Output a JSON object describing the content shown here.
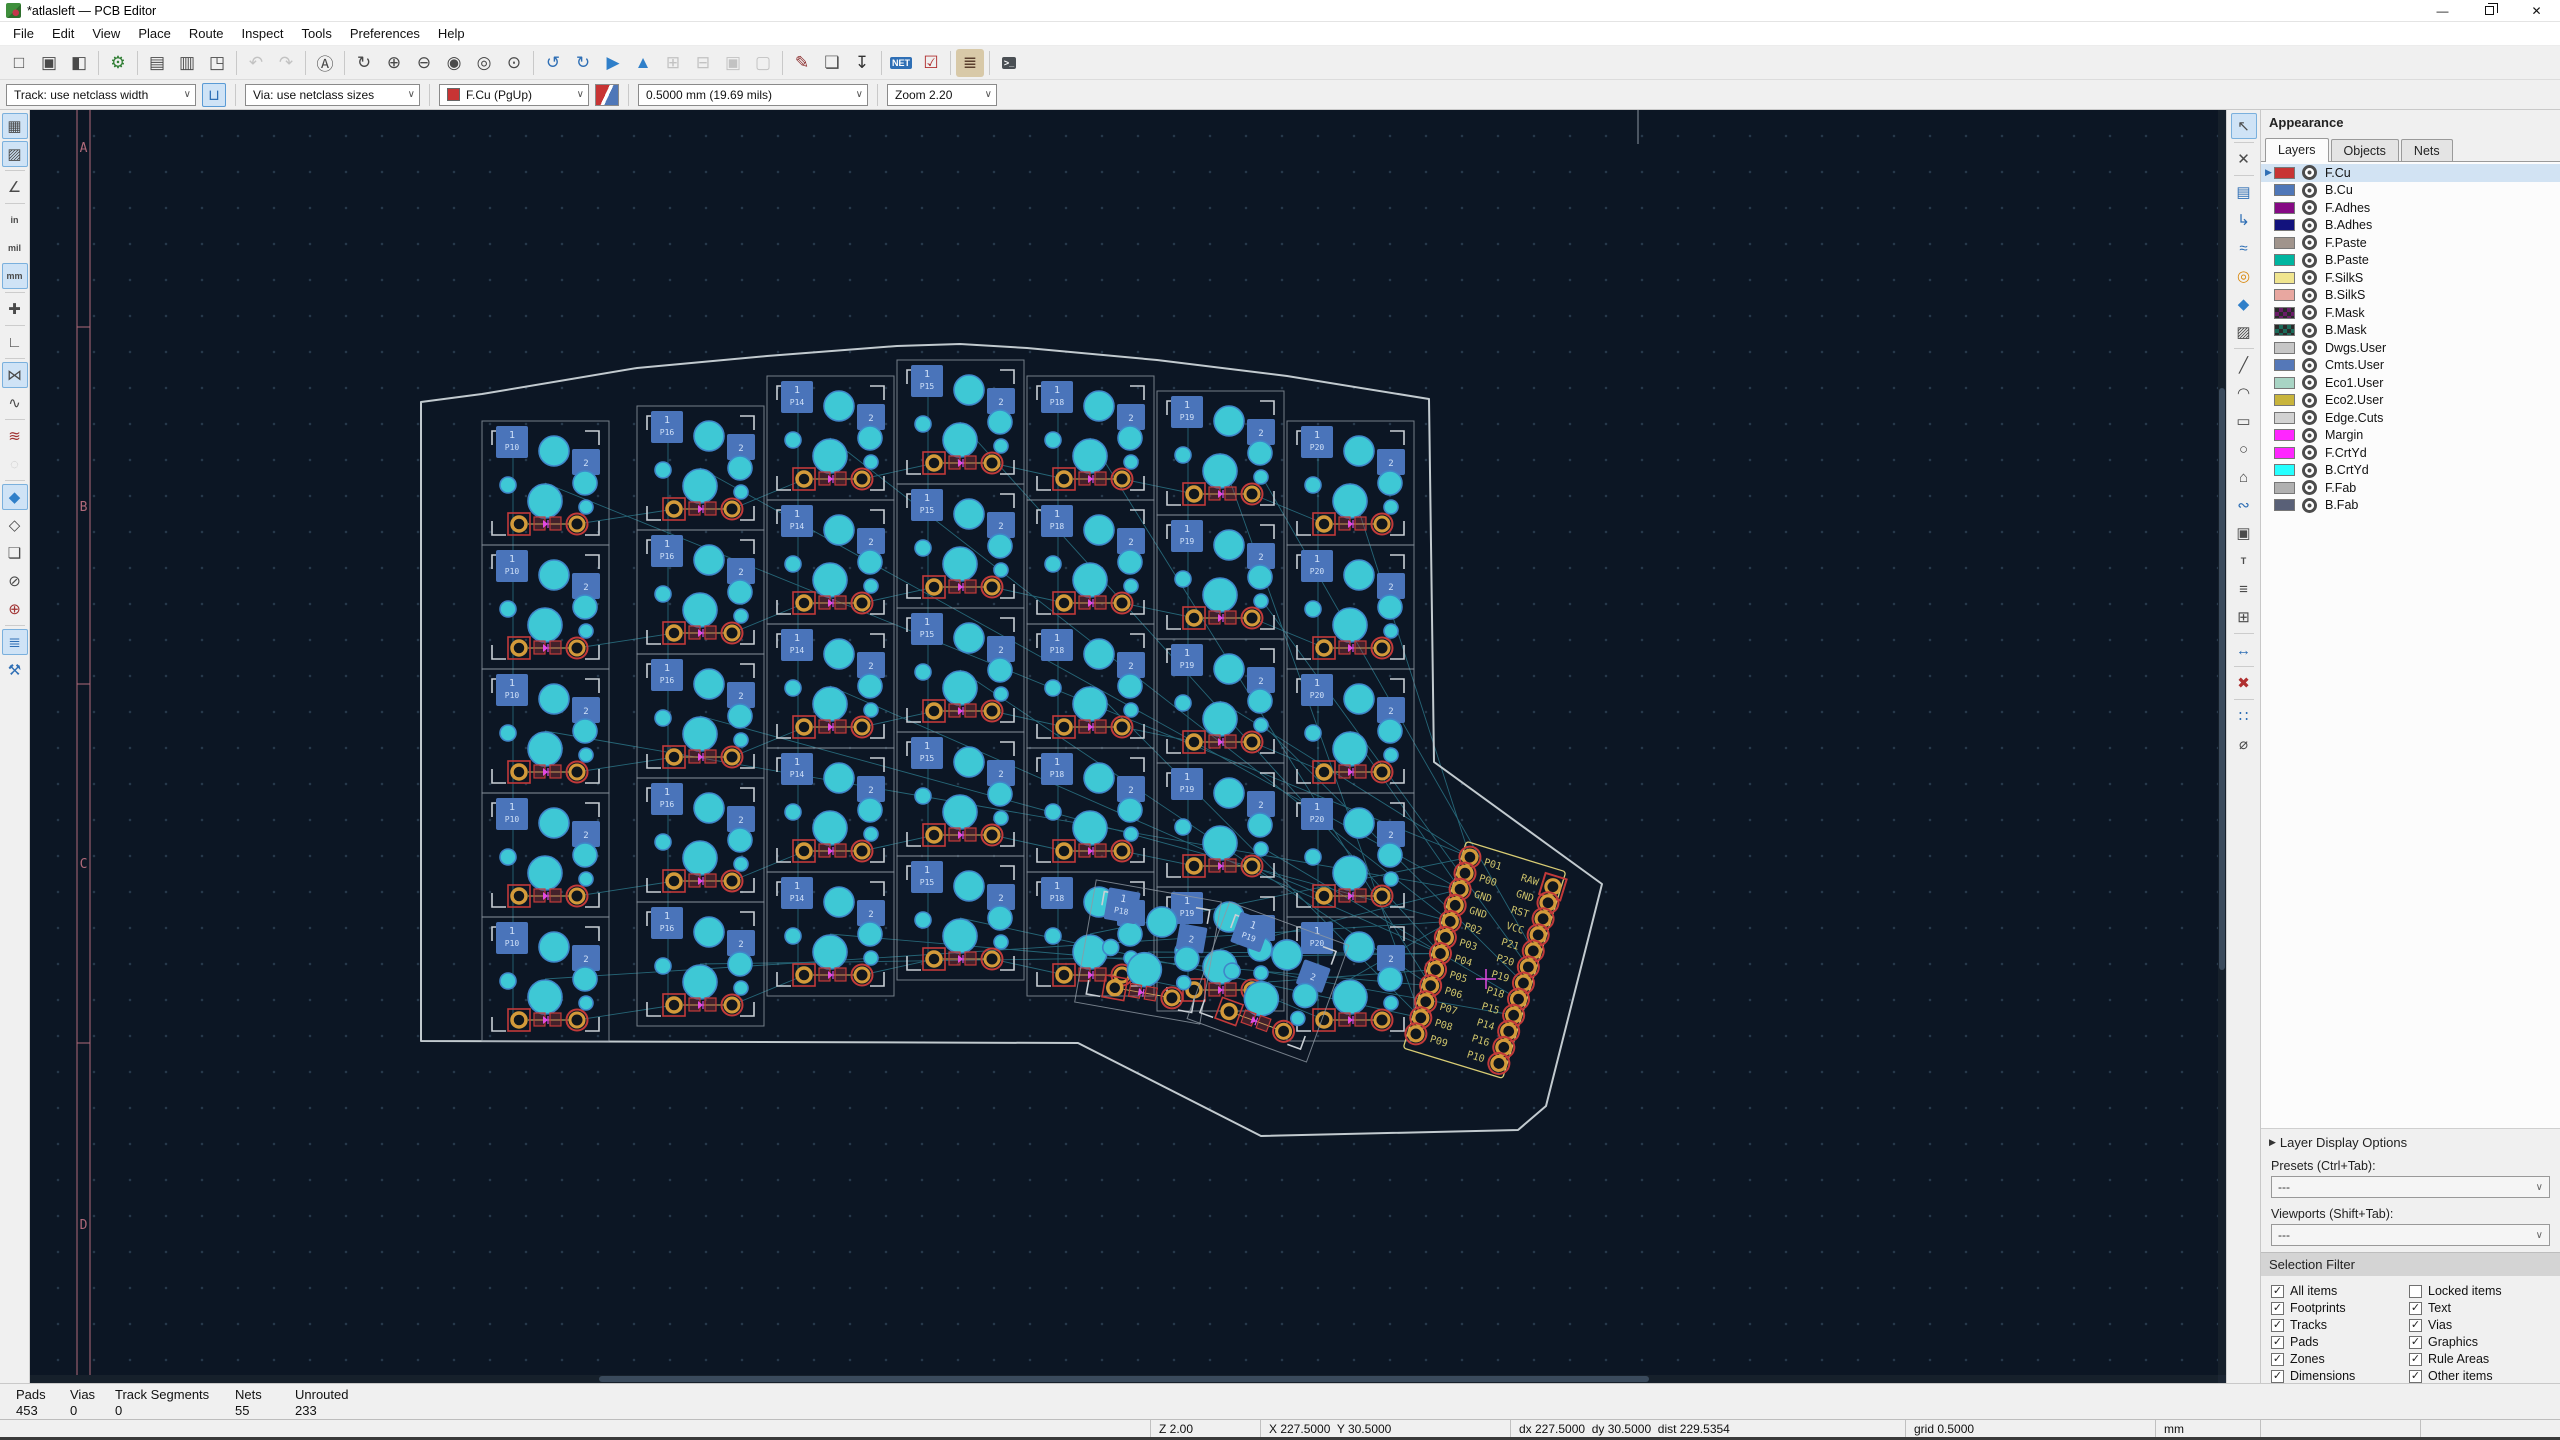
{
  "window": {
    "title": "*atlasleft — PCB Editor",
    "controls": {
      "minimize": "—",
      "close": "✕"
    }
  },
  "menu": {
    "items": [
      "File",
      "Edit",
      "View",
      "Place",
      "Route",
      "Inspect",
      "Tools",
      "Preferences",
      "Help"
    ]
  },
  "main_toolbar": {
    "groups": [
      [
        {
          "name": "new-board",
          "glyph": "□"
        },
        {
          "name": "open-board",
          "glyph": "▣"
        },
        {
          "name": "save-board",
          "glyph": "◧"
        }
      ],
      [
        {
          "name": "board-setup",
          "glyph": "⚙",
          "color": "#2e7d32"
        }
      ],
      [
        {
          "name": "page-settings",
          "glyph": "▤"
        },
        {
          "name": "print",
          "glyph": "▥"
        },
        {
          "name": "plot",
          "glyph": "◳"
        }
      ],
      [
        {
          "name": "undo",
          "glyph": "↶",
          "disabled": true
        },
        {
          "name": "redo",
          "glyph": "↷",
          "disabled": true
        }
      ],
      [
        {
          "name": "find",
          "glyph": "Ⓐ"
        }
      ],
      [
        {
          "name": "refresh-view",
          "glyph": "↻"
        },
        {
          "name": "zoom-in",
          "glyph": "⊕"
        },
        {
          "name": "zoom-out",
          "glyph": "⊖"
        },
        {
          "name": "zoom-to-fit",
          "glyph": "◉"
        },
        {
          "name": "zoom-to-objects",
          "glyph": "◎"
        },
        {
          "name": "zoom-to-selection",
          "glyph": "⊙"
        }
      ],
      [
        {
          "name": "rotate-ccw",
          "glyph": "↺",
          "color": "#2f6fb5"
        },
        {
          "name": "rotate-cw",
          "glyph": "↻",
          "color": "#2f6fb5"
        },
        {
          "name": "flip-horizontal",
          "glyph": "▶",
          "color": "#2f7fc9"
        },
        {
          "name": "flip-vertical",
          "glyph": "▲",
          "color": "#2f7fc9"
        },
        {
          "name": "group",
          "glyph": "⊞",
          "disabled": true
        },
        {
          "name": "ungroup",
          "glyph": "⊟",
          "disabled": true
        },
        {
          "name": "lock",
          "glyph": "▣",
          "disabled": true
        },
        {
          "name": "unlock",
          "glyph": "▢",
          "disabled": true
        }
      ],
      [
        {
          "name": "footprint-editor",
          "glyph": "✎",
          "color": "#8c2f2f"
        },
        {
          "name": "footprint-browser",
          "glyph": "❏"
        },
        {
          "name": "update-pcb-from-schematic",
          "glyph": "↧",
          "color": "#333333"
        }
      ],
      [
        {
          "name": "net-inspector",
          "label": "NET",
          "color": "#ffffff",
          "bg": "#2f6fb5"
        },
        {
          "name": "design-rules-checker",
          "glyph": "☑",
          "color": "#b03030"
        }
      ],
      [
        {
          "name": "plugin-keyboard-placer",
          "glyph": "≣",
          "color": "#5a3f2e",
          "bg": "#d8c9a8"
        }
      ],
      [
        {
          "name": "scripting-console",
          "label": ">_",
          "color": "#ffffff",
          "bg": "#4a4f54"
        }
      ]
    ]
  },
  "params_toolbar": {
    "track_width": "Track: use netclass width",
    "track_posture_glyph": "⊔",
    "via_size": "Via: use netclass sizes",
    "active_layer": "F.Cu (PgUp)",
    "active_layer_color": "#c83434",
    "grid": "0.5000 mm (19.69 mils)",
    "zoom": "Zoom 2.20",
    "combo_arrow": "∨"
  },
  "left_toolbar": {
    "groups": [
      [
        {
          "name": "toggle-grid",
          "glyph": "▦",
          "active": true
        },
        {
          "name": "toggle-grid-overrides",
          "glyph": "▨",
          "active": true
        }
      ],
      [
        {
          "name": "polar-coordinates",
          "glyph": "∠"
        }
      ],
      [
        {
          "name": "units-inches",
          "label": "in"
        },
        {
          "name": "units-mils",
          "label": "mil"
        },
        {
          "name": "units-mm",
          "label": "mm",
          "active": true
        }
      ],
      [
        {
          "name": "crosshair-cursor",
          "glyph": "✚"
        }
      ],
      [
        {
          "name": "limit-tracks-45",
          "glyph": "∟"
        }
      ],
      [
        {
          "name": "show-ratsnest",
          "glyph": "⋈",
          "active": true
        },
        {
          "name": "curved-ratsnest",
          "glyph": "∿"
        }
      ],
      [
        {
          "name": "track-display-mode",
          "glyph": "≋",
          "color": "#a03333"
        },
        {
          "name": "pad-display-mode",
          "glyph": "◌",
          "disabled": true
        }
      ],
      [
        {
          "name": "zone-fill-mode",
          "glyph": "◆",
          "active": true,
          "color": "#2f7fc9"
        },
        {
          "name": "zone-outline-mode",
          "glyph": "◇"
        },
        {
          "name": "footprint-outline-mode",
          "glyph": "❏"
        },
        {
          "name": "via-outline-mode",
          "glyph": "⊘"
        },
        {
          "name": "track-outline-mode",
          "glyph": "⊕",
          "color": "#a03333"
        }
      ],
      [
        {
          "name": "layers-manager",
          "glyph": "≣",
          "active": true,
          "color": "#2f6fb5"
        },
        {
          "name": "properties-panel",
          "glyph": "⚒",
          "color": "#2f6fb5"
        }
      ]
    ]
  },
  "right_toolbar": {
    "groups": [
      [
        {
          "name": "select-tool",
          "glyph": "↖",
          "active": true
        }
      ],
      [
        {
          "name": "highlight-local-ratsnest",
          "glyph": "✕"
        }
      ],
      [
        {
          "name": "add-footprint",
          "glyph": "▤",
          "color": "#2f6fb5"
        },
        {
          "name": "route-tracks",
          "glyph": "↳",
          "color": "#2f6fb5"
        },
        {
          "name": "route-differential-pairs",
          "glyph": "≈",
          "color": "#2f6fb5"
        },
        {
          "name": "add-via",
          "glyph": "◎",
          "color": "#d9890f"
        },
        {
          "name": "add-filled-zone",
          "glyph": "◆",
          "color": "#2f7fc9"
        },
        {
          "name": "add-rule-area",
          "glyph": "▨"
        }
      ],
      [
        {
          "name": "draw-line",
          "glyph": "╱"
        },
        {
          "name": "draw-arc",
          "glyph": "◠"
        },
        {
          "name": "draw-rectangle",
          "glyph": "▭"
        },
        {
          "name": "draw-circle",
          "glyph": "○"
        },
        {
          "name": "draw-polygon",
          "glyph": "⌂"
        },
        {
          "name": "draw-bezier",
          "glyph": "∾",
          "color": "#2f6fb5"
        },
        {
          "name": "add-image",
          "glyph": "▣"
        },
        {
          "name": "add-text",
          "label": "T"
        },
        {
          "name": "add-textbox",
          "glyph": "≡"
        },
        {
          "name": "add-table",
          "glyph": "⊞"
        }
      ],
      [
        {
          "name": "add-dimension",
          "glyph": "↔",
          "color": "#2f6fb5"
        }
      ],
      [
        {
          "name": "delete-tool",
          "glyph": "✖",
          "color": "#b03030"
        }
      ],
      [
        {
          "name": "grid-origin",
          "glyph": "∷",
          "color": "#2f6fb5"
        },
        {
          "name": "measure-tool",
          "glyph": "⌀"
        }
      ]
    ]
  },
  "appearance": {
    "title": "Appearance",
    "tabs": [
      {
        "label": "Layers",
        "active": true
      },
      {
        "label": "Objects",
        "active": false
      },
      {
        "label": "Nets",
        "active": false
      }
    ],
    "layers": [
      {
        "name": "F.Cu",
        "color": "#c83434",
        "selected": true
      },
      {
        "name": "B.Cu",
        "color": "#4f77b8"
      },
      {
        "name": "F.Adhes",
        "color": "#850984"
      },
      {
        "name": "B.Adhes",
        "color": "#12127d"
      },
      {
        "name": "F.Paste",
        "color": "#a0948c"
      },
      {
        "name": "B.Paste",
        "color": "#00b5a0"
      },
      {
        "name": "F.SilkS",
        "color": "#f0e58f"
      },
      {
        "name": "B.SilkS",
        "color": "#e8a7a0"
      },
      {
        "name": "F.Mask",
        "color": "#6a1b68",
        "checker": true
      },
      {
        "name": "B.Mask",
        "color": "#1a6a58",
        "checker": true
      },
      {
        "name": "Dwgs.User",
        "color": "#c6c6c6"
      },
      {
        "name": "Cmts.User",
        "color": "#5578b8"
      },
      {
        "name": "Eco1.User",
        "color": "#a8d4c4"
      },
      {
        "name": "Eco2.User",
        "color": "#c8b43c"
      },
      {
        "name": "Edge.Cuts",
        "color": "#d2d2d2"
      },
      {
        "name": "Margin",
        "color": "#ff26ff"
      },
      {
        "name": "F.CrtYd",
        "color": "#ff26ff"
      },
      {
        "name": "B.CrtYd",
        "color": "#26ffff"
      },
      {
        "name": "F.Fab",
        "color": "#b0b0b0"
      },
      {
        "name": "B.Fab",
        "color": "#596077"
      }
    ],
    "layer_display_options": "Layer Display Options",
    "presets_label": "Presets (Ctrl+Tab):",
    "presets_value": "---",
    "viewports_label": "Viewports (Shift+Tab):",
    "viewports_value": "---",
    "selection_filter": {
      "title": "Selection Filter",
      "items": [
        {
          "label": "All items",
          "checked": true
        },
        {
          "label": "Locked items",
          "checked": false
        },
        {
          "label": "Footprints",
          "checked": true
        },
        {
          "label": "Text",
          "checked": true
        },
        {
          "label": "Tracks",
          "checked": true
        },
        {
          "label": "Vias",
          "checked": true
        },
        {
          "label": "Pads",
          "checked": true
        },
        {
          "label": "Graphics",
          "checked": true
        },
        {
          "label": "Zones",
          "checked": true
        },
        {
          "label": "Rule Areas",
          "checked": true
        },
        {
          "label": "Dimensions",
          "checked": true
        },
        {
          "label": "Other items",
          "checked": true
        }
      ]
    }
  },
  "status": {
    "message_fields": [
      {
        "label": "Pads",
        "value": "453",
        "x": 16,
        "w": 54
      },
      {
        "label": "Vias",
        "value": "0",
        "x": 70,
        "w": 45
      },
      {
        "label": "Track Segments",
        "value": "0",
        "x": 115,
        "w": 120
      },
      {
        "label": "Nets",
        "value": "55",
        "x": 235,
        "w": 60
      },
      {
        "label": "Unrouted",
        "value": "233",
        "x": 295,
        "w": 100
      }
    ],
    "zoom_level": "Z 2.00",
    "position": "X 227.5000  Y 30.5000",
    "delta": "dx 227.5000  dy 30.5000  dist 229.5354",
    "grid": "grid 0.5000",
    "units": "mm"
  },
  "canvas": {
    "sheet": {
      "color": "#b06a7a",
      "line1_x": 47,
      "line2_x": 60,
      "row_labels": [
        {
          "label": "A",
          "y": 37
        },
        {
          "label": "B",
          "y": 396
        },
        {
          "label": "C",
          "y": 753
        },
        {
          "label": "D",
          "y": 1114
        }
      ],
      "dividers_y": [
        217,
        574,
        933
      ],
      "top_tick_x": 1608
    },
    "edge_color": "#c2cacf",
    "board_outline": [
      [
        391,
        292
      ],
      [
        452,
        284
      ],
      [
        607,
        258
      ],
      [
        737,
        246
      ],
      [
        867,
        236
      ],
      [
        930,
        234
      ],
      [
        997,
        238
      ],
      [
        1127,
        250
      ],
      [
        1257,
        266
      ],
      [
        1399,
        289
      ],
      [
        1404,
        652
      ],
      [
        1572,
        774
      ],
      [
        1516,
        996
      ],
      [
        1488,
        1020
      ],
      [
        1231,
        1026
      ],
      [
        1048,
        933
      ],
      [
        391,
        931
      ]
    ],
    "columns": [
      {
        "x": 452,
        "y": 311,
        "net": "P10"
      },
      {
        "x": 607,
        "y": 296,
        "net": "P16"
      },
      {
        "x": 737,
        "y": 266,
        "net": "P14"
      },
      {
        "x": 867,
        "y": 250,
        "net": "P15"
      },
      {
        "x": 997,
        "y": 266,
        "net": "P18"
      },
      {
        "x": 1127,
        "y": 281,
        "net": "P19"
      },
      {
        "x": 1257,
        "y": 311,
        "net": "P20"
      }
    ],
    "rows": 5,
    "cell_w": 127,
    "cell_h": 124,
    "thumb_keys": [
      {
        "cx": 1118,
        "cy": 842,
        "rot": 10,
        "net": "P18"
      },
      {
        "cx": 1238,
        "cy": 872,
        "rot": 20,
        "net": "P19"
      }
    ],
    "controller": {
      "x": 1482,
      "y": 760,
      "rot": 17,
      "pitch": 16.8,
      "half_width": 44,
      "left_pins": [
        "P01",
        "P00",
        "GND",
        "GND",
        "P02",
        "P03",
        "P04",
        "P05",
        "P06",
        "P07",
        "P08",
        "P09"
      ],
      "right_pins": [
        "RAW",
        "GND",
        "RST",
        "VCC",
        "P21",
        "P20",
        "P19",
        "P18",
        "P15",
        "P14",
        "P16",
        "P10"
      ],
      "silk_color": "#d8cc74",
      "label_color": "#cdc26a"
    },
    "origin_cross": {
      "x": 1456,
      "y": 869,
      "color": "#e24ae2"
    },
    "colors": {
      "pad_blue": "#4a74ba",
      "pad_blue_text": "#cfe0f8",
      "hole_cyan": "#3ec8d5",
      "hole_ring": "#3f86c9",
      "pad_red": "#c23a3a",
      "pad_gold": "#d39a3a",
      "hole_dark": "#10161c",
      "silk_yellow": "#cfc46a",
      "ratsnest": "#3fb3c8",
      "bracket": "#c9cfd5",
      "cell_outline": "#8e98a2",
      "magenta": "#e24ae2"
    }
  }
}
